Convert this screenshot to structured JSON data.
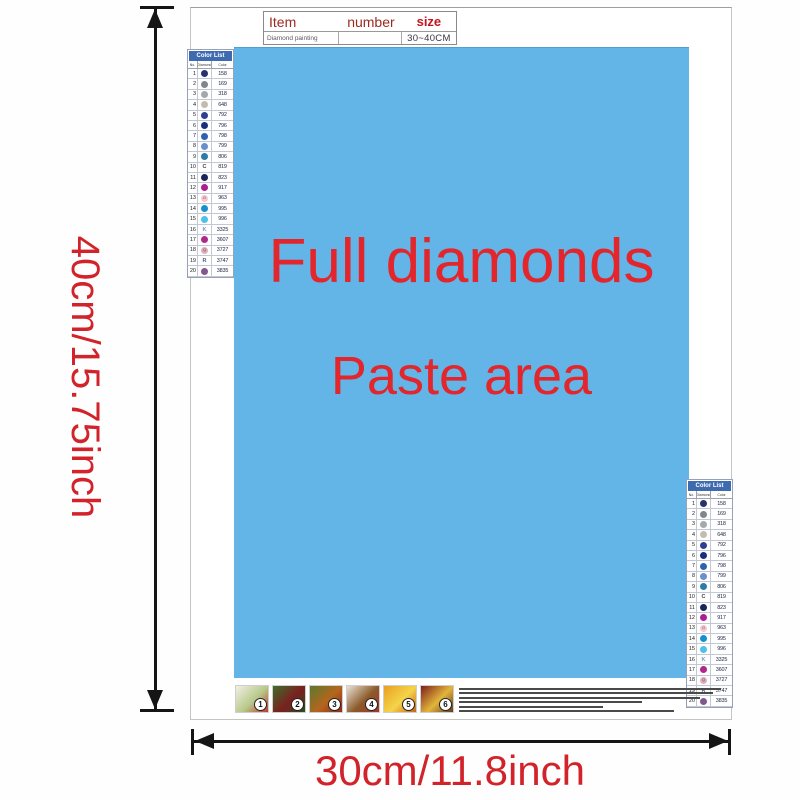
{
  "size_labels": {
    "height": "40cm/15.75inch",
    "width": "30cm/11.8inch",
    "color": "#d2232a"
  },
  "item_table": {
    "col_item": "Item",
    "col_number": "number",
    "col_size": "size",
    "row_item": "Diamond painting",
    "row_number": "",
    "row_size": "30~40CM",
    "header_color": "#9c2a20",
    "size_header_color": "#c6131f"
  },
  "paste_area": {
    "line1": "Full diamonds",
    "line2": "Paste area",
    "bg": "#63b4e7",
    "text_color": "#e2262b"
  },
  "color_list": {
    "title": "Color List",
    "header_bg": "#3e6ab0",
    "columns": [
      "No.",
      "Diamond",
      "Color"
    ],
    "rows": [
      {
        "no": "1",
        "code": "158",
        "sym": "",
        "dot": "#27316b",
        "ink": "#ffffff"
      },
      {
        "no": "2",
        "code": "169",
        "sym": "",
        "dot": "#7e868f",
        "ink": "#ffffff"
      },
      {
        "no": "3",
        "code": "318",
        "sym": "",
        "dot": "#a5a8ad",
        "ink": "#ffffff"
      },
      {
        "no": "4",
        "code": "648",
        "sym": "",
        "dot": "#c3bdb1",
        "ink": "#555555"
      },
      {
        "no": "5",
        "code": "792",
        "sym": "",
        "dot": "#2f3f92",
        "ink": "#ffffff"
      },
      {
        "no": "6",
        "code": "796",
        "sym": "",
        "dot": "#1a2f7c",
        "ink": "#ffffff"
      },
      {
        "no": "7",
        "code": "798",
        "sym": "",
        "dot": "#2f62ae",
        "ink": "#ffffff"
      },
      {
        "no": "8",
        "code": "799",
        "sym": "",
        "dot": "#6d8fc9",
        "ink": "#ffffff"
      },
      {
        "no": "9",
        "code": "806",
        "sym": "",
        "dot": "#2e7ca6",
        "ink": "#ffffff"
      },
      {
        "no": "10",
        "code": "819",
        "sym": "C",
        "dot": "",
        "ink": "#444444"
      },
      {
        "no": "11",
        "code": "823",
        "sym": "",
        "dot": "#1b2559",
        "ink": "#ffffff"
      },
      {
        "no": "12",
        "code": "917",
        "sym": "",
        "dot": "#a9218e",
        "ink": "#ffffff"
      },
      {
        "no": "13",
        "code": "963",
        "sym": "G",
        "dot": "#f5c8cf",
        "ink": "#7a4450"
      },
      {
        "no": "14",
        "code": "995",
        "sym": "",
        "dot": "#1790d2",
        "ink": "#ffffff"
      },
      {
        "no": "15",
        "code": "996",
        "sym": "",
        "dot": "#4fc0e8",
        "ink": "#ffffff"
      },
      {
        "no": "16",
        "code": "3325",
        "sym": "K",
        "dot": "",
        "ink": "#7593b5"
      },
      {
        "no": "17",
        "code": "3607",
        "sym": "",
        "dot": "#b02889",
        "ink": "#ffffff"
      },
      {
        "no": "18",
        "code": "3727",
        "sym": "Q",
        "dot": "#dcb0bd",
        "ink": "#6a3c4c"
      },
      {
        "no": "19",
        "code": "3747",
        "sym": "R",
        "dot": "",
        "ink": "#555c8c"
      },
      {
        "no": "20",
        "code": "3835",
        "sym": "",
        "dot": "#82568f",
        "ink": "#ffffff"
      }
    ]
  },
  "steps": [
    {
      "n": "1",
      "colors": [
        "#f3efe6",
        "#b7c98a",
        "#c0392b"
      ]
    },
    {
      "n": "2",
      "colors": [
        "#3e6e2a",
        "#7b1f1f",
        "#2c4d1e"
      ]
    },
    {
      "n": "3",
      "colors": [
        "#5a7a2e",
        "#b5651d",
        "#8f2b1e"
      ]
    },
    {
      "n": "4",
      "colors": [
        "#e9e2d5",
        "#8c5a2b",
        "#a83226"
      ]
    },
    {
      "n": "5",
      "colors": [
        "#e8a020",
        "#f5d44a",
        "#c8641a"
      ]
    },
    {
      "n": "6",
      "colors": [
        "#7c1f1c",
        "#e3b53a",
        "#5d3b1e"
      ]
    }
  ]
}
